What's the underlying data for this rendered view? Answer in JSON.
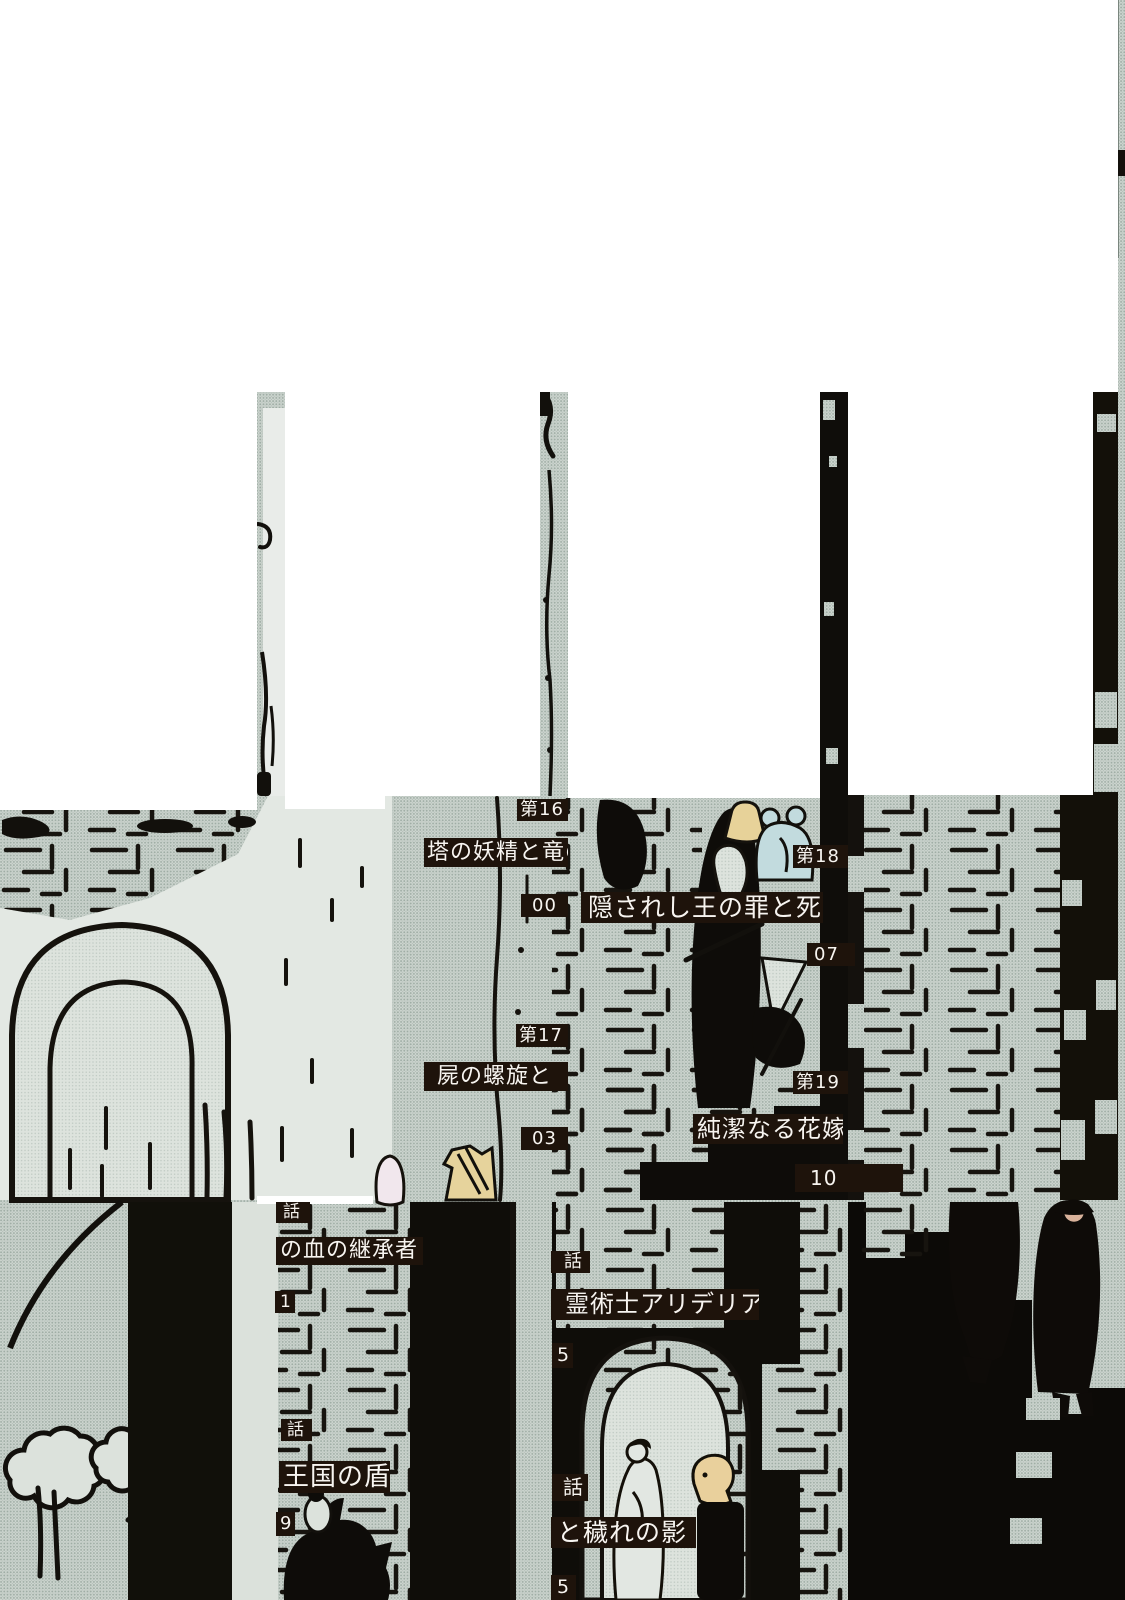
{
  "page": {
    "kind": "manga-volume-table-of-contents",
    "width_px": 1125,
    "height_px": 1600
  },
  "colors": {
    "blank_tile": "#ffffff",
    "halftone_base": "#cdd5cf",
    "halftone_dot": "#9fada5",
    "ink": "#12100c",
    "label_background": "#1e130b",
    "label_text": "#f7f4f0",
    "plain_light": "#e3e8e3",
    "figure_yellow": "#e7d299",
    "figure_blue": "#c2dbde",
    "figure_flesh": "#d9b29b",
    "figure_pink_white": "#f1e7ed"
  },
  "toc": {
    "entries": [
      {
        "no": "第16",
        "title": "塔の妖精と竜の",
        "page": "00"
      },
      {
        "no": "第17",
        "title": "屍の螺旋と",
        "page": "03"
      },
      {
        "no": "第18",
        "title": "隠されし王の罪と死",
        "page": "07"
      },
      {
        "no": "第19",
        "title": "純潔なる花嫁",
        "page": "10"
      },
      {
        "no": "話",
        "title": "の血の継承者",
        "page": "1"
      },
      {
        "no": "話",
        "title": "王国の盾",
        "page": "9"
      },
      {
        "no": "話",
        "title": "霊術士アリデリア",
        "page": "5"
      },
      {
        "no": "話",
        "title": "と穢れの影",
        "page": "5"
      }
    ]
  }
}
